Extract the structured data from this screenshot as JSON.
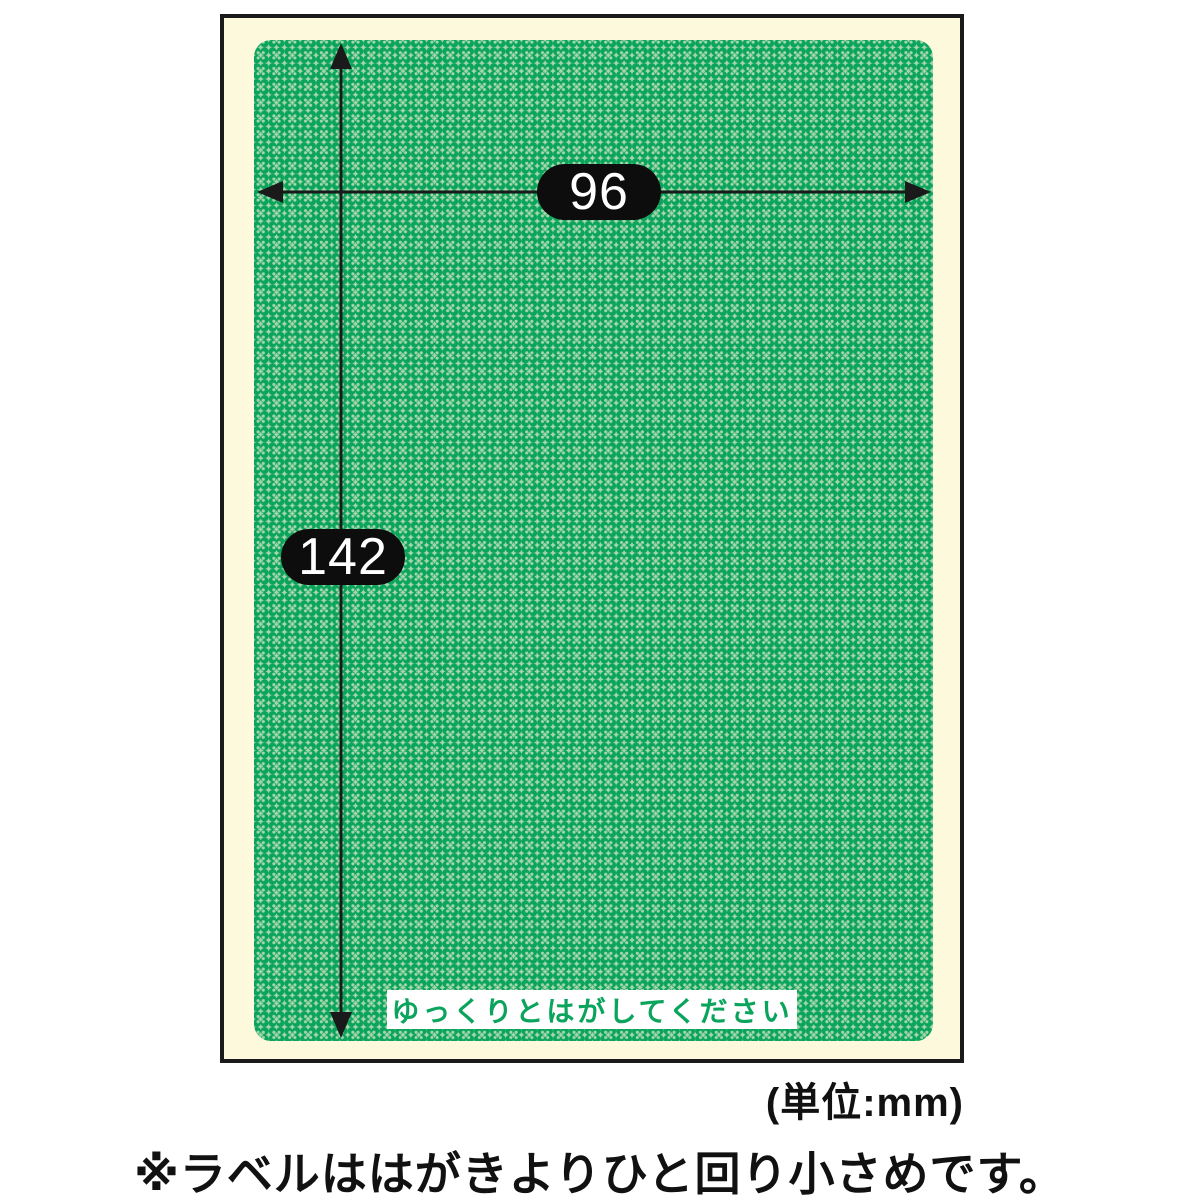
{
  "diagram": {
    "width_mm": "96",
    "height_mm": "142",
    "peel_instruction": "ゆっくりとはがしてください",
    "unit_note": "(単位:mm)",
    "footnote": "※ラベルははがきよりひと回り小さめです。"
  },
  "colors": {
    "page_bg": "#ffffff",
    "postcard_bg": "#fcf9dc",
    "outline_black": "#1a1a1a",
    "label_green": "#0aa45c",
    "label_green_light": "#a6d6ab",
    "badge_bg": "#0d0d0d",
    "badge_text": "#ffffff",
    "instruction_bg": "#ffffff",
    "instruction_text": "#0aa45c",
    "note_text": "#111111"
  }
}
